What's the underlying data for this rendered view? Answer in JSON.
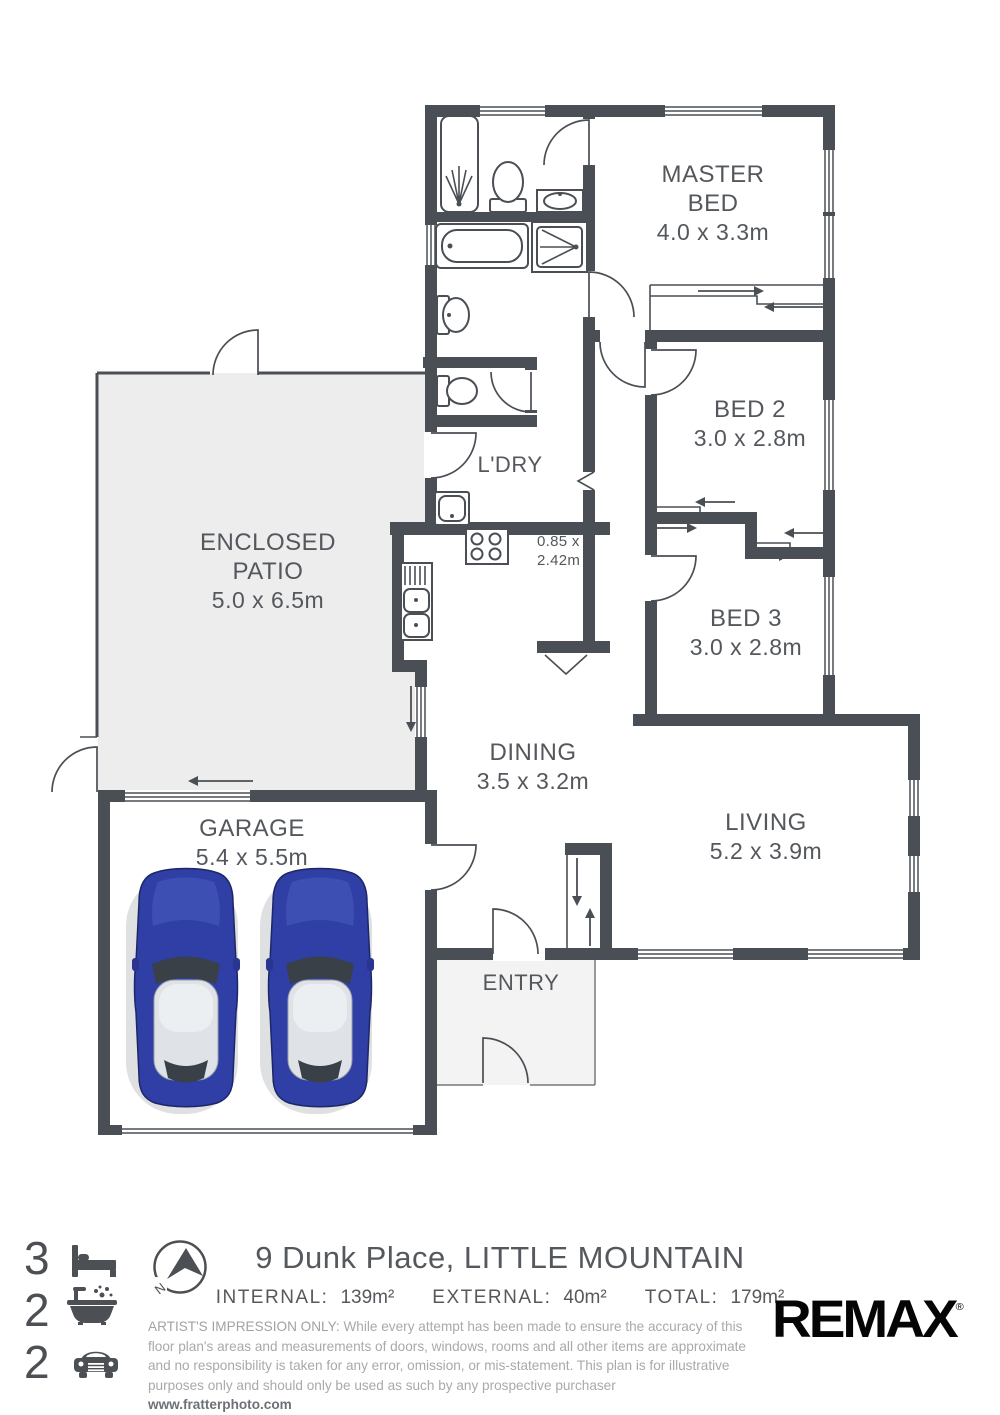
{
  "colors": {
    "wall": "#4a4f55",
    "label_text": "#54585d",
    "patio_fill": "#ededee",
    "porch_fill": "#f3f3f4",
    "disclaimer_gray": "#a9a9a9",
    "car_body_blue": "#2f3fa5",
    "car_roof_silver": "#dfe3e7",
    "brand_black": "#050505"
  },
  "plan": {
    "master": {
      "l1": "MASTER",
      "l2": "BED",
      "dims": "4.0 x 3.3m"
    },
    "bed2": {
      "l1": "BED 2",
      "dims": "3.0 x 2.8m"
    },
    "bed3": {
      "l1": "BED 3",
      "dims": "3.0 x 2.8m"
    },
    "patio": {
      "l1": "ENCLOSED",
      "l2": "PATIO",
      "dims": "5.0 x 6.5m"
    },
    "laundry": {
      "l1": "L'DRY"
    },
    "kitchen": {
      "l1": "0.85 x",
      "l2": "2.42m"
    },
    "dining": {
      "l1": "DINING",
      "dims": "3.5 x 3.2m"
    },
    "living": {
      "l1": "LIVING",
      "dims": "5.2 x 3.9m"
    },
    "garage": {
      "l1": "GARAGE",
      "dims": "5.4 x 5.5m"
    },
    "entry": {
      "l1": "ENTRY"
    }
  },
  "footer": {
    "bedrooms": "3",
    "bathrooms": "2",
    "car_spaces": "2",
    "compass_north": "N",
    "address": "9 Dunk Place, LITTLE MOUNTAIN",
    "areas": {
      "internal_label": "INTERNAL:",
      "internal_value": "139m²",
      "external_label": "EXTERNAL:",
      "external_value": "40m²",
      "total_label": "TOTAL:",
      "total_value": "179m²"
    },
    "disclaimer_heading": "ARTIST'S IMPRESSION ONLY:",
    "disclaimer_body": " While every attempt has been made to ensure the accuracy of this floor plan's areas and measurements of doors, windows, rooms and all other items are approximate and no responsibility is taken for any error, omission, or mis-statement. This plan is for illustrative purposes only and should only be used as such by any prospective purchaser ",
    "website": "www.fratterphoto.com",
    "brand": "REMAX",
    "brand_mark": "®"
  }
}
